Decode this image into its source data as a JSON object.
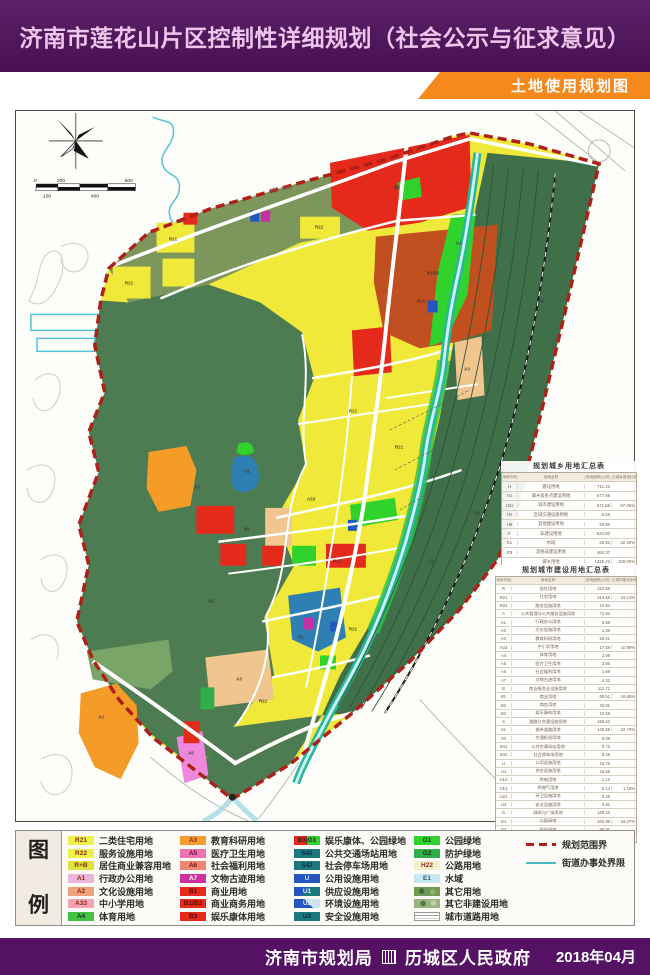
{
  "header": {
    "title": "济南市莲花山片区控制性详细规划（社会公示与征求意见）"
  },
  "banner": {
    "label": "土地使用规划图"
  },
  "map": {
    "compass": "N",
    "scale": {
      "t0": "0",
      "t1": "200",
      "t2": "600",
      "b0": "100",
      "b1": "400"
    },
    "road_label": "经十东路",
    "block_labels": [
      {
        "x": 128,
        "y": 282,
        "t": "R21"
      },
      {
        "x": 172,
        "y": 238,
        "t": "R21"
      },
      {
        "x": 318,
        "y": 226,
        "t": "R22"
      },
      {
        "x": 396,
        "y": 186,
        "t": "B1"
      },
      {
        "x": 432,
        "y": 272,
        "t": "B1/B2"
      },
      {
        "x": 458,
        "y": 242,
        "t": "G1"
      },
      {
        "x": 420,
        "y": 300,
        "t": "R21"
      },
      {
        "x": 466,
        "y": 368,
        "t": "A3"
      },
      {
        "x": 352,
        "y": 410,
        "t": "R21"
      },
      {
        "x": 398,
        "y": 446,
        "t": "R21"
      },
      {
        "x": 310,
        "y": 498,
        "t": "A33"
      },
      {
        "x": 246,
        "y": 528,
        "t": "B1"
      },
      {
        "x": 336,
        "y": 560,
        "t": "R21"
      },
      {
        "x": 300,
        "y": 636,
        "t": "E1"
      },
      {
        "x": 238,
        "y": 678,
        "t": "A3"
      },
      {
        "x": 352,
        "y": 628,
        "t": "R21"
      },
      {
        "x": 262,
        "y": 700,
        "t": "R22"
      },
      {
        "x": 246,
        "y": 470,
        "t": "U1"
      },
      {
        "x": 540,
        "y": 300,
        "t": "G2"
      },
      {
        "x": 476,
        "y": 512,
        "t": "G2"
      },
      {
        "x": 196,
        "y": 486,
        "t": "A3"
      },
      {
        "x": 100,
        "y": 716,
        "t": "A3"
      },
      {
        "x": 190,
        "y": 752,
        "t": "A5"
      },
      {
        "x": 430,
        "y": 560,
        "t": "G1"
      },
      {
        "x": 210,
        "y": 600,
        "t": "G1"
      }
    ],
    "tables": [
      {
        "title": "规划城乡用地汇总表",
        "col_headers": [
          "用地代码",
          "用地名称",
          "用地面积(公顷)",
          "占城乡用地比例(%)"
        ],
        "rows": [
          [
            "H",
            "建设用地",
            "711.43",
            ""
          ],
          [
            "H1",
            "城乡居民点建设用地",
            "677.68",
            ""
          ],
          [
            "H11",
            "城市建设用地",
            "671.66",
            "97.06%"
          ],
          [
            "H2",
            "区域交通设施用地",
            "6.25",
            ""
          ],
          [
            "H9",
            "其他建设用地",
            "25.90",
            ""
          ],
          [
            "E",
            "非建设用地",
            "524.00",
            ""
          ],
          [
            "E1",
            "水域",
            "25.82",
            "42.40%"
          ],
          [
            "E9",
            "其他非建设用地",
            "460.37",
            ""
          ],
          [
            "",
            "城乡用地",
            "1235.22",
            "100.00%"
          ]
        ]
      },
      {
        "title": "规划城市建设用地汇总表",
        "col_headers": [
          "用地代码",
          "用地名称",
          "用地面积(公顷)",
          "占城市建设用地比例(%)"
        ],
        "rows": [
          [
            "R",
            "居住用地",
            "222.58",
            ""
          ],
          [
            "R21",
            "住宅用地",
            "213.55",
            "33.13%"
          ],
          [
            "R22",
            "服务设施用地",
            "10.84",
            ""
          ],
          [
            "A",
            "公共管理与公共服务设施用地",
            "71.92",
            ""
          ],
          [
            "A1",
            "行政办公用地",
            "5.88",
            ""
          ],
          [
            "A2",
            "文化设施用地",
            "1.36",
            ""
          ],
          [
            "A3",
            "教育科研用地",
            "55.41",
            ""
          ],
          [
            "A33",
            "中小学用地",
            "17.59",
            "10.89%"
          ],
          [
            "A4",
            "体育用地",
            "2.98",
            ""
          ],
          [
            "A5",
            "医疗卫生用地",
            "2.56",
            ""
          ],
          [
            "A6",
            "社会福利用地",
            "1.68",
            ""
          ],
          [
            "A7",
            "文物古迹用地",
            "4.32",
            ""
          ],
          [
            "B",
            "商业服务业设施用地",
            "111.72",
            ""
          ],
          [
            "B1",
            "商业用地",
            "68.51",
            "16.85%"
          ],
          [
            "B2",
            "商务用地",
            "42.91",
            ""
          ],
          [
            "B3",
            "娱乐康体用地",
            "10.58",
            ""
          ],
          [
            "S",
            "道路与交通设施用地",
            "155.52",
            ""
          ],
          [
            "S1",
            "城市道路用地",
            "145.58",
            "22.79%"
          ],
          [
            "S3",
            "交通枢纽用地",
            "9.38",
            ""
          ],
          [
            "S41",
            "公共交通场站用地",
            "0.73",
            ""
          ],
          [
            "S42",
            "社会停车场用地",
            "9.28",
            ""
          ],
          [
            "U",
            "公用设施用地",
            "16.75",
            ""
          ],
          [
            "U1",
            "供应设施用地",
            "15.68",
            ""
          ],
          [
            "U12",
            "供电用地",
            "1.13",
            ""
          ],
          [
            "U13",
            "供燃气用地",
            "5.14",
            "1.16%"
          ],
          [
            "U22",
            "环卫设施用地",
            "0.25",
            ""
          ],
          [
            "U3",
            "安全设施用地",
            "0.82",
            ""
          ],
          [
            "G",
            "绿地与广场用地",
            "189.26",
            ""
          ],
          [
            "G1",
            "公园绿地",
            "102.35",
            "42.27%"
          ],
          [
            "G2",
            "防护绿地",
            "86.91",
            ""
          ],
          [
            "",
            "城市建设用地",
            "671.66",
            "100.00%"
          ]
        ]
      }
    ]
  },
  "legend": {
    "title_chars": [
      "图",
      "例"
    ],
    "columns": [
      [
        {
          "code": "R21",
          "label": "二类住宅用地",
          "color": "#eef04c",
          "text": "#8a2c14"
        },
        {
          "code": "R22",
          "label": "服务设施用地",
          "color": "#eef04c",
          "text": "#8a2c14"
        },
        {
          "code": "R+B",
          "label": "居住商业兼容用地",
          "color": "#dde23c",
          "text": "#8a2c14"
        },
        {
          "code": "A1",
          "label": "行政办公用地",
          "color": "#ecb6dc",
          "text": "#8a2c14"
        },
        {
          "code": "A2",
          "label": "文化设施用地",
          "color": "#eda27c",
          "text": "#8a2c14"
        },
        {
          "code": "A33",
          "label": "中小学用地",
          "color": "#f4a2b4",
          "text": "#8a2c14"
        },
        {
          "code": "A4",
          "label": "体育用地",
          "color": "#44c244",
          "text": "#0a3a1a"
        }
      ],
      [
        {
          "code": "A3",
          "label": "教育科研用地",
          "color": "#f59d2e",
          "text": "#8a2c14"
        },
        {
          "code": "A5",
          "label": "医疗卫生用地",
          "color": "#ee72b0",
          "text": "#6a0a3a"
        },
        {
          "code": "A6",
          "label": "社会福利用地",
          "color": "#ee8672",
          "text": "#7a1408"
        },
        {
          "code": "A7",
          "label": "文物古迹用地",
          "color": "#cd2f9e",
          "text": "#ffffff"
        },
        {
          "code": "B1",
          "label": "商业用地",
          "color": "#e52a1c",
          "text": "#5a0a04"
        },
        {
          "code": "B1/B2",
          "label": "商业商务用地",
          "color": "#e52a1c",
          "text": "#5a0a04"
        },
        {
          "code": "B3",
          "label": "娱乐康体用地",
          "color": "#e52a1c",
          "text": "#5a0a04"
        }
      ],
      [
        {
          "code": "B3|G1",
          "label": "娱乐康体、公园绿地",
          "swatch": "sw-split",
          "text": "#222"
        },
        {
          "code": "S41",
          "label": "公共交通场站用地",
          "color": "#1b7a80",
          "text": "#0a2a44"
        },
        {
          "code": "S42",
          "label": "社会停车场用地",
          "color": "#1b7a80",
          "text": "#0a2a44"
        },
        {
          "code": "U",
          "label": "公用设施用地",
          "color": "#2356c0",
          "text": "#cfe0ff"
        },
        {
          "code": "U1",
          "label": "供应设施用地",
          "swatch": "sw-diag",
          "text": "#dce8f0"
        },
        {
          "code": "U2",
          "label": "环境设施用地",
          "swatch": "sw-tri",
          "text": "#dce8f0"
        },
        {
          "code": "U3",
          "label": "安全设施用地",
          "color": "#1b7a80",
          "text": "#0a2a44"
        }
      ],
      [
        {
          "code": "G1",
          "label": "公园绿地",
          "color": "#30d32b",
          "text": "#0a3a1a"
        },
        {
          "code": "G2",
          "label": "防护绿地",
          "color": "#2fae4a",
          "text": "#0a3a1a"
        },
        {
          "code": "H22",
          "label": "公路用地",
          "color": "#f3efc9",
          "text": "#8a2c14"
        },
        {
          "code": "E1",
          "label": "水域",
          "color": "#c6e8f0",
          "text": "#2a5a74"
        },
        {
          "code": "",
          "label": "其它用地",
          "swatch": "sw-camo1",
          "text": "#222"
        },
        {
          "code": "",
          "label": "其它非建设用地",
          "swatch": "sw-camo2",
          "text": "#222"
        },
        {
          "code": "",
          "label": "城市道路用地",
          "swatch": "sw-road",
          "text": "#222"
        }
      ]
    ],
    "lines": [
      {
        "label": "规划范围界",
        "style": "ln-red"
      },
      {
        "label": "街道办事处界限",
        "style": "ln-teal"
      }
    ]
  },
  "footer": {
    "agency1": "济南市规划局",
    "agency2": "历城区人民政府",
    "date": "2018年04月"
  }
}
